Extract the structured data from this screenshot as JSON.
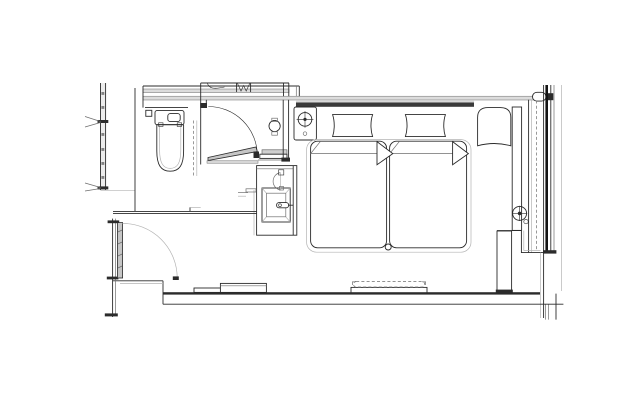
{
  "canvas": {
    "width": 640,
    "height": 400,
    "background": "#ffffff"
  },
  "palette": {
    "bg": "#ffffff",
    "line_dark": "#2b2b2b",
    "line_medium": "#6e6e6e",
    "line_light": "#b3b3b3",
    "wall_fill": "#dcdcdc",
    "door_fill": "#c6c6c6",
    "glazing": "#141414"
  },
  "drawing": {
    "kind": "architectural-floor-plan",
    "text_labels": [],
    "elements": [
      {
        "id": "corridor-wall",
        "label": "corridor wall with mullion ticks"
      },
      {
        "id": "corridor-door-swings",
        "label": "door swing leader lines from corridor"
      },
      {
        "id": "entry-door",
        "label": "entry door leaf with quarter-circle swing"
      },
      {
        "id": "closet",
        "label": "closet with hook and hanger symbol"
      },
      {
        "id": "bathroom-door",
        "label": "bathroom door with swing arc"
      },
      {
        "id": "toilet",
        "label": "toilet with cistern and flush plate"
      },
      {
        "id": "glass-partition",
        "label": "dashed partition line"
      },
      {
        "id": "vanity-sink",
        "label": "vanity counter with square basin and faucet"
      },
      {
        "id": "shower-step",
        "label": "threshold step at bathroom door"
      },
      {
        "id": "headboard",
        "label": "headboard panel"
      },
      {
        "id": "nightstand",
        "label": "nightstand with table lamp"
      },
      {
        "id": "pillows",
        "label": "two pillows"
      },
      {
        "id": "twin-beds",
        "label": "two adjacent beds with folded duvet corners"
      },
      {
        "id": "luggage-bench",
        "label": "low bench on bottom wall"
      },
      {
        "id": "wall-unit",
        "label": "wall unit with dashed grille"
      },
      {
        "id": "lounge-chair",
        "label": "lounge chair"
      },
      {
        "id": "window-side-column",
        "label": "column with round fixture"
      },
      {
        "id": "window-wall",
        "label": "glazed window wall with mullions and dashed center line"
      },
      {
        "id": "balcony-step",
        "label": "stepped wall and pier at lower right"
      },
      {
        "id": "bottom-wall",
        "label": "bottom exterior wall"
      }
    ]
  }
}
